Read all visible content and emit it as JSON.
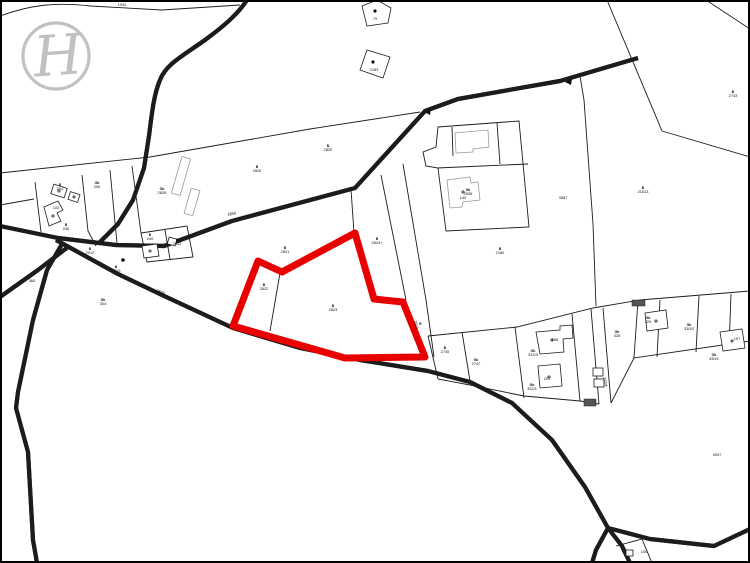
{
  "page": {
    "type": "cadastral-parcel-map",
    "background": "#ffffff",
    "frame_color": "#000000",
    "line_color": "#1c1c1c"
  },
  "logo": {
    "letter": "H",
    "color": "#b7b7b7"
  },
  "highlight": {
    "color": "#e80000",
    "parcel_symbol": "B",
    "parcel_number": "2823",
    "outline_width": 7
  },
  "labels": [
    {
      "x": 122,
      "y": 6,
      "b": "1944"
    },
    {
      "x": 375,
      "y": 20,
      "b": "79"
    },
    {
      "x": 374,
      "y": 71,
      "b": "2183"
    },
    {
      "x": 733,
      "y": 93,
      "t": "B",
      "b": "2743"
    },
    {
      "x": 643,
      "y": 189,
      "t": "B",
      "b": "21813"
    },
    {
      "x": 257,
      "y": 168,
      "t": "B",
      "b": "2825"
    },
    {
      "x": 328,
      "y": 147,
      "t": "B",
      "b": "2820"
    },
    {
      "x": 285,
      "y": 249,
      "t": "B",
      "b": "2821"
    },
    {
      "x": 264,
      "y": 286,
      "t": "B",
      "b": "2822"
    },
    {
      "x": 333,
      "y": 307,
      "t": "B",
      "b": "2823"
    },
    {
      "x": 377,
      "y": 240,
      "t": "B",
      "b": "2824+"
    },
    {
      "x": 419,
      "y": 324,
      "t": "B",
      "b": "2819",
      "r": 76
    },
    {
      "x": 500,
      "y": 250,
      "t": "B",
      "b": "2180"
    },
    {
      "x": 468,
      "y": 191,
      "t": "Gb",
      "b": "2836"
    },
    {
      "x": 563,
      "y": 199,
      "b": "3587"
    },
    {
      "x": 162,
      "y": 190,
      "t": "Gb",
      "b": "2826"
    },
    {
      "x": 97,
      "y": 184,
      "t": "Gb",
      "b": "206"
    },
    {
      "x": 60,
      "y": 186,
      "t": "B",
      "b": "204"
    },
    {
      "x": 56,
      "y": 209,
      "b": "102"
    },
    {
      "x": 66,
      "y": 226,
      "t": "B",
      "b": "246"
    },
    {
      "x": 150,
      "y": 236,
      "t": "B",
      "b": "240"
    },
    {
      "x": 90,
      "y": 250,
      "t": "B",
      "b": "2012"
    },
    {
      "x": 116,
      "y": 268,
      "t": "B",
      "b": "202/1"
    },
    {
      "x": 177,
      "y": 241,
      "t": "B",
      "b": "2812"
    },
    {
      "x": 32,
      "y": 282,
      "b": "360"
    },
    {
      "x": 103,
      "y": 301,
      "t": "Gb",
      "b": "304"
    },
    {
      "x": 445,
      "y": 349,
      "t": "B",
      "b": "2745"
    },
    {
      "x": 476,
      "y": 361,
      "t": "Gb",
      "b": "2747"
    },
    {
      "x": 533,
      "y": 352,
      "t": "Gb",
      "b": "332/3"
    },
    {
      "x": 532,
      "y": 386,
      "t": "Gb",
      "b": "332/1"
    },
    {
      "x": 555,
      "y": 341,
      "b": "158"
    },
    {
      "x": 547,
      "y": 380,
      "b": "201"
    },
    {
      "x": 617,
      "y": 333,
      "t": "Gb",
      "b": "328"
    },
    {
      "x": 604,
      "y": 382,
      "b": "332/4",
      "r": 80
    },
    {
      "x": 648,
      "y": 319,
      "t": "Gb",
      "b": "329"
    },
    {
      "x": 689,
      "y": 326,
      "t": "Gb",
      "b": "330/2"
    },
    {
      "x": 737,
      "y": 340,
      "b": "157"
    },
    {
      "x": 714,
      "y": 356,
      "t": "Gb",
      "b": "330/1"
    },
    {
      "x": 717,
      "y": 456,
      "b": "4937"
    },
    {
      "x": 463,
      "y": 199,
      "b": "140"
    },
    {
      "x": 232,
      "y": 215,
      "b": "2850",
      "r": -9
    },
    {
      "x": 452,
      "y": 379,
      "b": "2807",
      "r": 11
    },
    {
      "x": 160,
      "y": 293,
      "b": "2849",
      "r": 24
    },
    {
      "x": 644,
      "y": 553,
      "b": "150"
    }
  ]
}
